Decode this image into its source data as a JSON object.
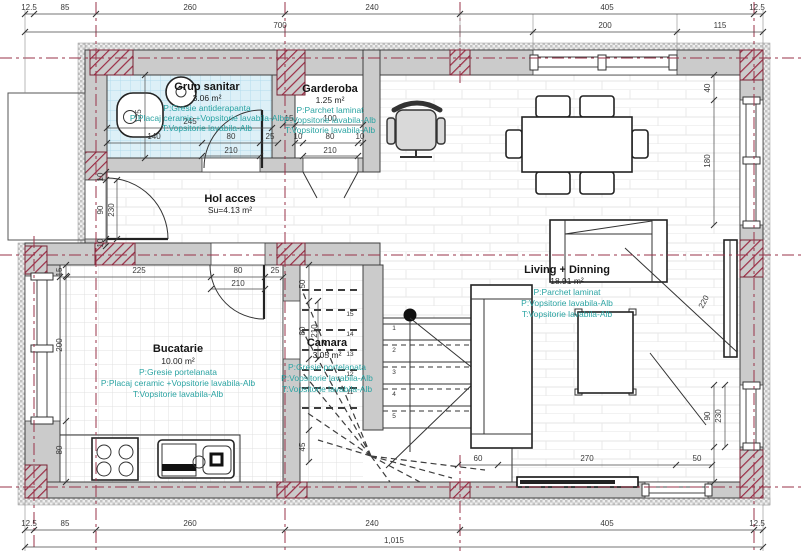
{
  "rooms": {
    "bath": {
      "name": "Grup sanitar",
      "area": "3.06 m²",
      "finishes": [
        "P:Gresie antiderapanta",
        "P:Placaj ceramic +Vopsitorie lavabila-Alb",
        "T:Vopsitorie lavabila-Alb"
      ]
    },
    "gard": {
      "name": "Garderoba",
      "area": "1.25 m²",
      "finishes": [
        "P:Parchet laminat",
        "P:Vopsitorie lavabila-Alb",
        "T:Vopsitorie lavabila-Alb"
      ]
    },
    "hol": {
      "name": "Hol acces",
      "area": "Su=4.13 m²"
    },
    "kitchen": {
      "name": "Bucatarie",
      "area": "10.00 m²",
      "finishes": [
        "P:Gresie portelanata",
        "P:Placaj ceramic +Vopsitorie lavabila-Alb",
        "T:Vopsitorie lavabila-Alb"
      ]
    },
    "camara": {
      "name": "Camara",
      "area": "3.05 m²",
      "finishes": [
        "P:Gresie portelanata",
        "P:Vopsitorie lavabila-Alb",
        "T:Vopsitorie lavabila-Alb"
      ]
    },
    "living": {
      "name": "Living + Dinning",
      "area": "18.91 m²",
      "finishes": [
        "P:Parchet laminat",
        "P:Vopsitorie lavabila-Alb",
        "T:Vopsitorie lavabila-Alb"
      ]
    }
  },
  "dims": {
    "top1": [
      "12.5",
      "85",
      "260",
      "240",
      "405",
      "12.5"
    ],
    "top2": [
      "700",
      "200",
      "115"
    ],
    "bot1": [
      "12.5",
      "85",
      "260",
      "240",
      "405",
      "12.5"
    ],
    "total": "1,015",
    "bath": {
      "w": "245",
      "h": "125",
      "door": [
        "140",
        "80",
        "25"
      ],
      "door_h": "210"
    },
    "gard": {
      "top": [
        "15",
        "100"
      ],
      "door": [
        "10",
        "80",
        "10"
      ],
      "door_h": "210"
    },
    "entry": [
      "10",
      "90",
      "230",
      "10"
    ],
    "kit": {
      "top": [
        "225",
        "80",
        "25"
      ],
      "door_h": "210",
      "left": [
        "15",
        "200",
        "80"
      ]
    },
    "cam": {
      "left": [
        "50",
        "80",
        "45"
      ],
      "door_h": "210"
    },
    "liv_bottom": [
      "60",
      "270",
      "50"
    ],
    "right_top": [
      "40",
      "180"
    ],
    "tv_dist": "220",
    "right_win": [
      "90",
      "230"
    ]
  },
  "stairs": {
    "flight": [
      "1",
      "2",
      "3",
      "4",
      "5"
    ],
    "under": [
      "15",
      "14",
      "13",
      "12",
      "11"
    ]
  },
  "colors": {
    "axis": "#993349",
    "column_hatch": "#9b2c45",
    "finish_text": "#2ba4a3",
    "wall": "#cbcbcb",
    "bath_tile": "#ddf0f7"
  }
}
